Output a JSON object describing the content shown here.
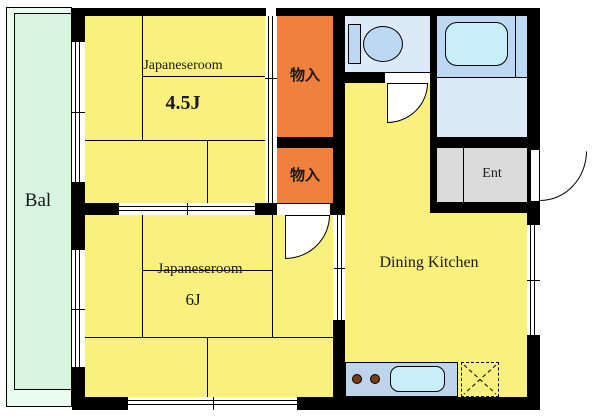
{
  "plan_title": "apartment-floor-plan",
  "colors": {
    "wall": "#000000",
    "tatami_room": "#f9f07e",
    "closet": "#f0803e",
    "balcony": "#d6f4df",
    "balcony_outer": "#eafbf0",
    "sanitary_light": "#dceaf8",
    "bath": "#bcd8f2",
    "fixture_fill": "#c8eef9",
    "entrance": "#dbdbdb",
    "counter": "#bed4eb",
    "burner": "#7b3a12"
  },
  "labels": {
    "balcony": "Bal",
    "room1_name": "Japaneseroom",
    "room1_size": "4.5J",
    "closet_top": "物入",
    "closet_bottom": "物入",
    "room2_name": "Japaneseroom",
    "room2_size": "6J",
    "dining_kitchen": "Dining Kitchen",
    "entrance": "Ent"
  }
}
